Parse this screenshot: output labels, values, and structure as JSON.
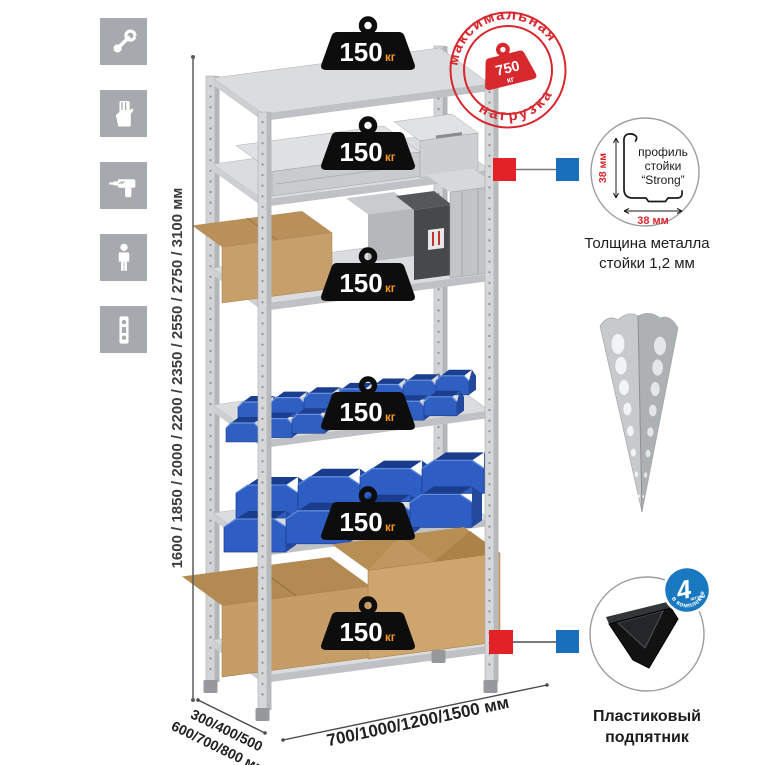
{
  "window": {
    "background": "#ffffff"
  },
  "sidebar": {
    "icons": [
      {
        "name": "wrench"
      },
      {
        "name": "work-gloves"
      },
      {
        "name": "drill"
      },
      {
        "name": "person"
      },
      {
        "name": "spirit-level"
      }
    ]
  },
  "rack": {
    "shelf_count": 6,
    "shelf_load_value": "150",
    "shelf_load_unit": "кг"
  },
  "max_load_stamp": {
    "arc_top": "максимальная",
    "arc_bottom": "нагрузка",
    "value": "750",
    "unit": "кг"
  },
  "dimensions": {
    "height_options": "1600 / 1850 / 2000 / 2200 / 2350 / 2550 / 2750 / 3100 мм",
    "depth_options_line1": "300/400/500",
    "depth_options_line2": "600/700/800 мм",
    "width_options": "700/1000/1200/1500 мм"
  },
  "profile_callout": {
    "line1": "профиль",
    "line2": "стойки",
    "line3": "“Strong”",
    "dim_vertical": "38 мм",
    "dim_horizontal": "38 мм",
    "caption_line1": "Толщина металла",
    "caption_line2": "стойки 1,2 мм"
  },
  "foot_callout": {
    "badge_value": "4",
    "badge_unit": "штуки",
    "badge_arc": "в комплекте",
    "caption_line1": "Пластиковый",
    "caption_line2": "подпятник"
  },
  "colors": {
    "accent_red": "#d7282e",
    "connector_red": "#e32227",
    "connector_blue": "#1a6fba",
    "badge_blue": "#1878c0",
    "bin_blue": "#2e5ec3",
    "weight_black": "#0d0d0d",
    "unit_orange": "#f7941d",
    "metal_gray": "#d2d4d6",
    "icon_tile_gray": "#a6a9ad"
  }
}
